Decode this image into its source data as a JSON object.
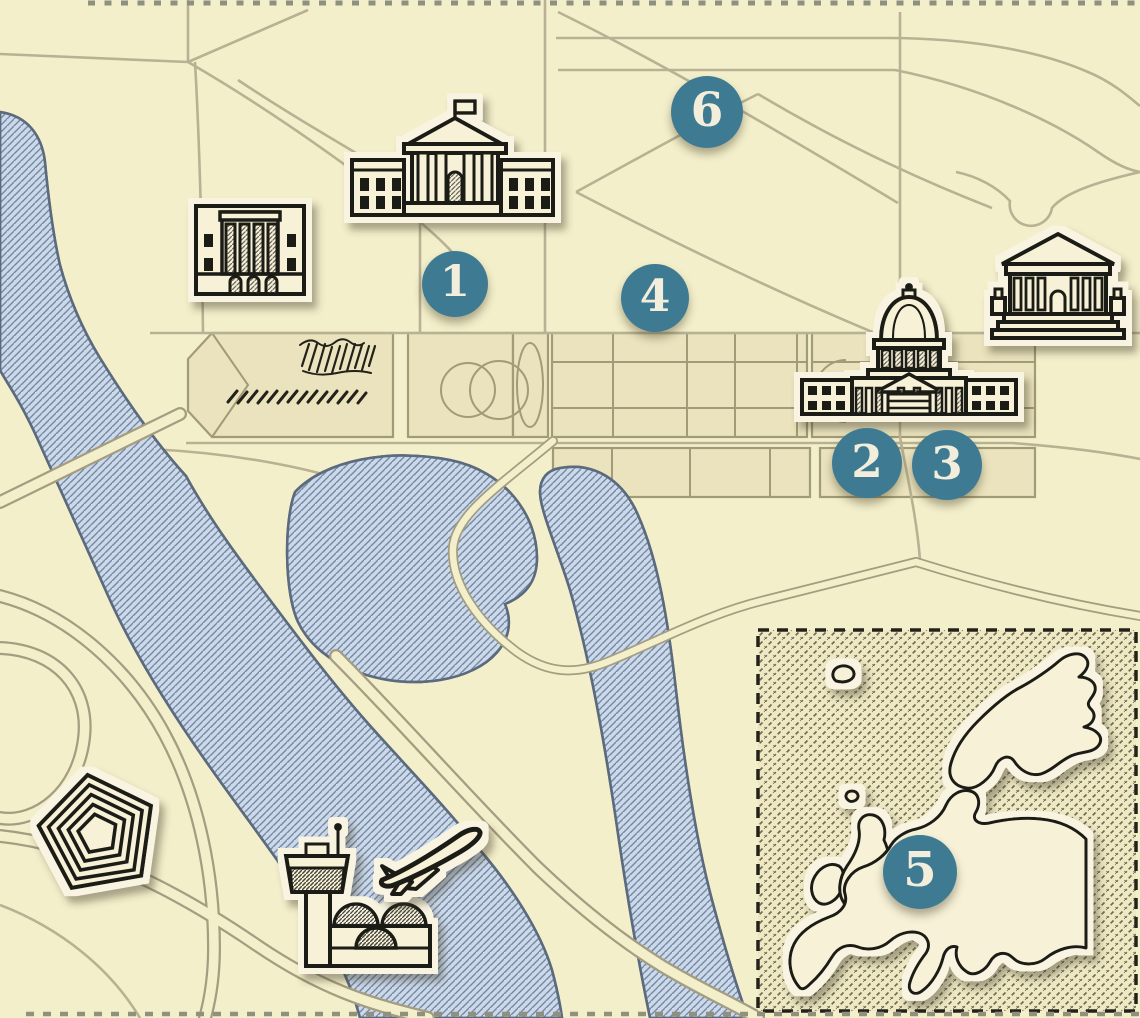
{
  "map": {
    "markers": [
      {
        "label": "1"
      },
      {
        "label": "2"
      },
      {
        "label": "3"
      },
      {
        "label": "4"
      },
      {
        "label": "5"
      },
      {
        "label": "6"
      }
    ],
    "landmarks": [
      {
        "icon": "white-house-icon"
      },
      {
        "icon": "capitol-icon"
      },
      {
        "icon": "supreme-court-icon"
      },
      {
        "icon": "federal-building-icon"
      },
      {
        "icon": "pentagon-icon"
      },
      {
        "icon": "airport-tower-icon"
      },
      {
        "icon": "airplane-takeoff-icon"
      },
      {
        "icon": "europe-inset-map"
      }
    ],
    "colors": {
      "background": "#f4efcb",
      "panel": "#eae3bd",
      "road_line": "#b8b194",
      "road_casing": "#a49d81",
      "water_fill": "#ccd9ea",
      "water_hatch": "#7487a0",
      "water_outline": "#5c6a7e",
      "ink": "#1b1a12",
      "sticker_halo": "#f8f4e1",
      "marker": "#3e7b93",
      "marker_text": "#f3eedb",
      "inset_bg": "#eee8c3"
    }
  }
}
